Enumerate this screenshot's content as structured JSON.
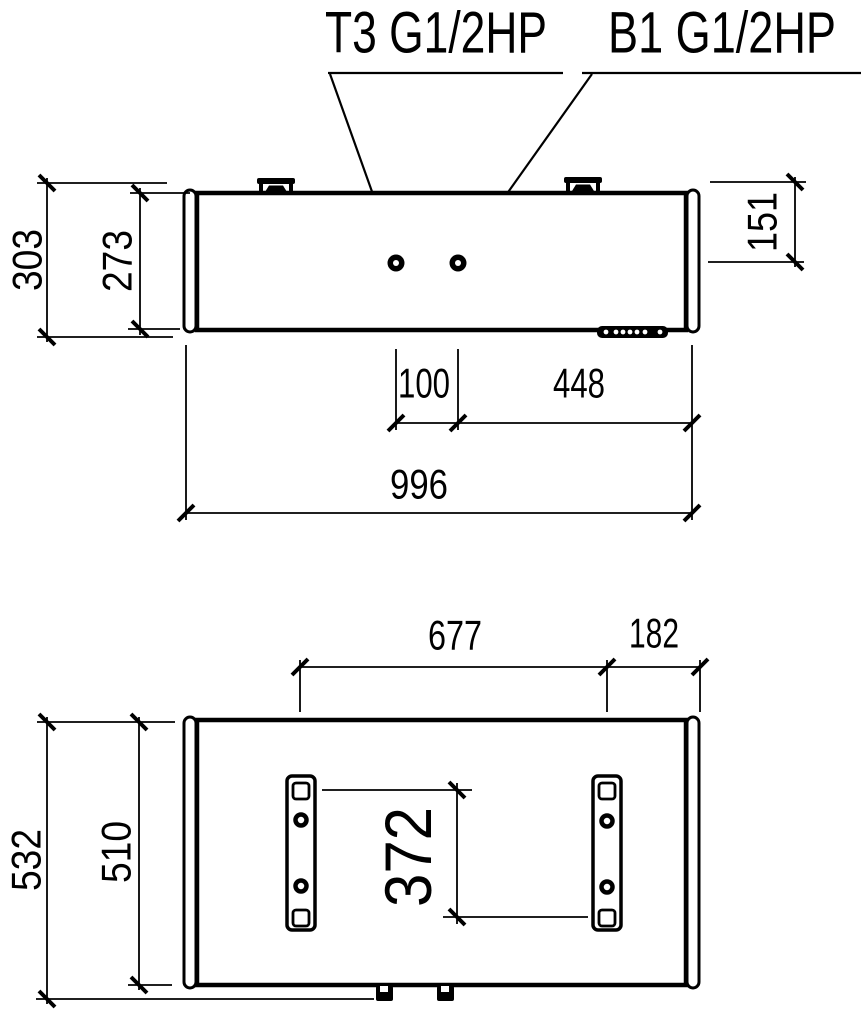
{
  "drawing": {
    "title_labels": {
      "t3_port": "T3 G1/2HP",
      "b1_port": "B1 G1/2HP"
    },
    "side_view": {
      "height_overall": "303",
      "height_body": "273",
      "port_depth": "151",
      "port_spacing": "100",
      "port_to_right_end": "448",
      "length_overall": "996"
    },
    "bottom_view": {
      "strap_spacing": "677",
      "strap_to_end": "182",
      "width_overall": "532",
      "width_body": "510",
      "strap_hole_spacing": "372"
    },
    "colors": {
      "line": "#000000",
      "background": "#ffffff"
    }
  }
}
